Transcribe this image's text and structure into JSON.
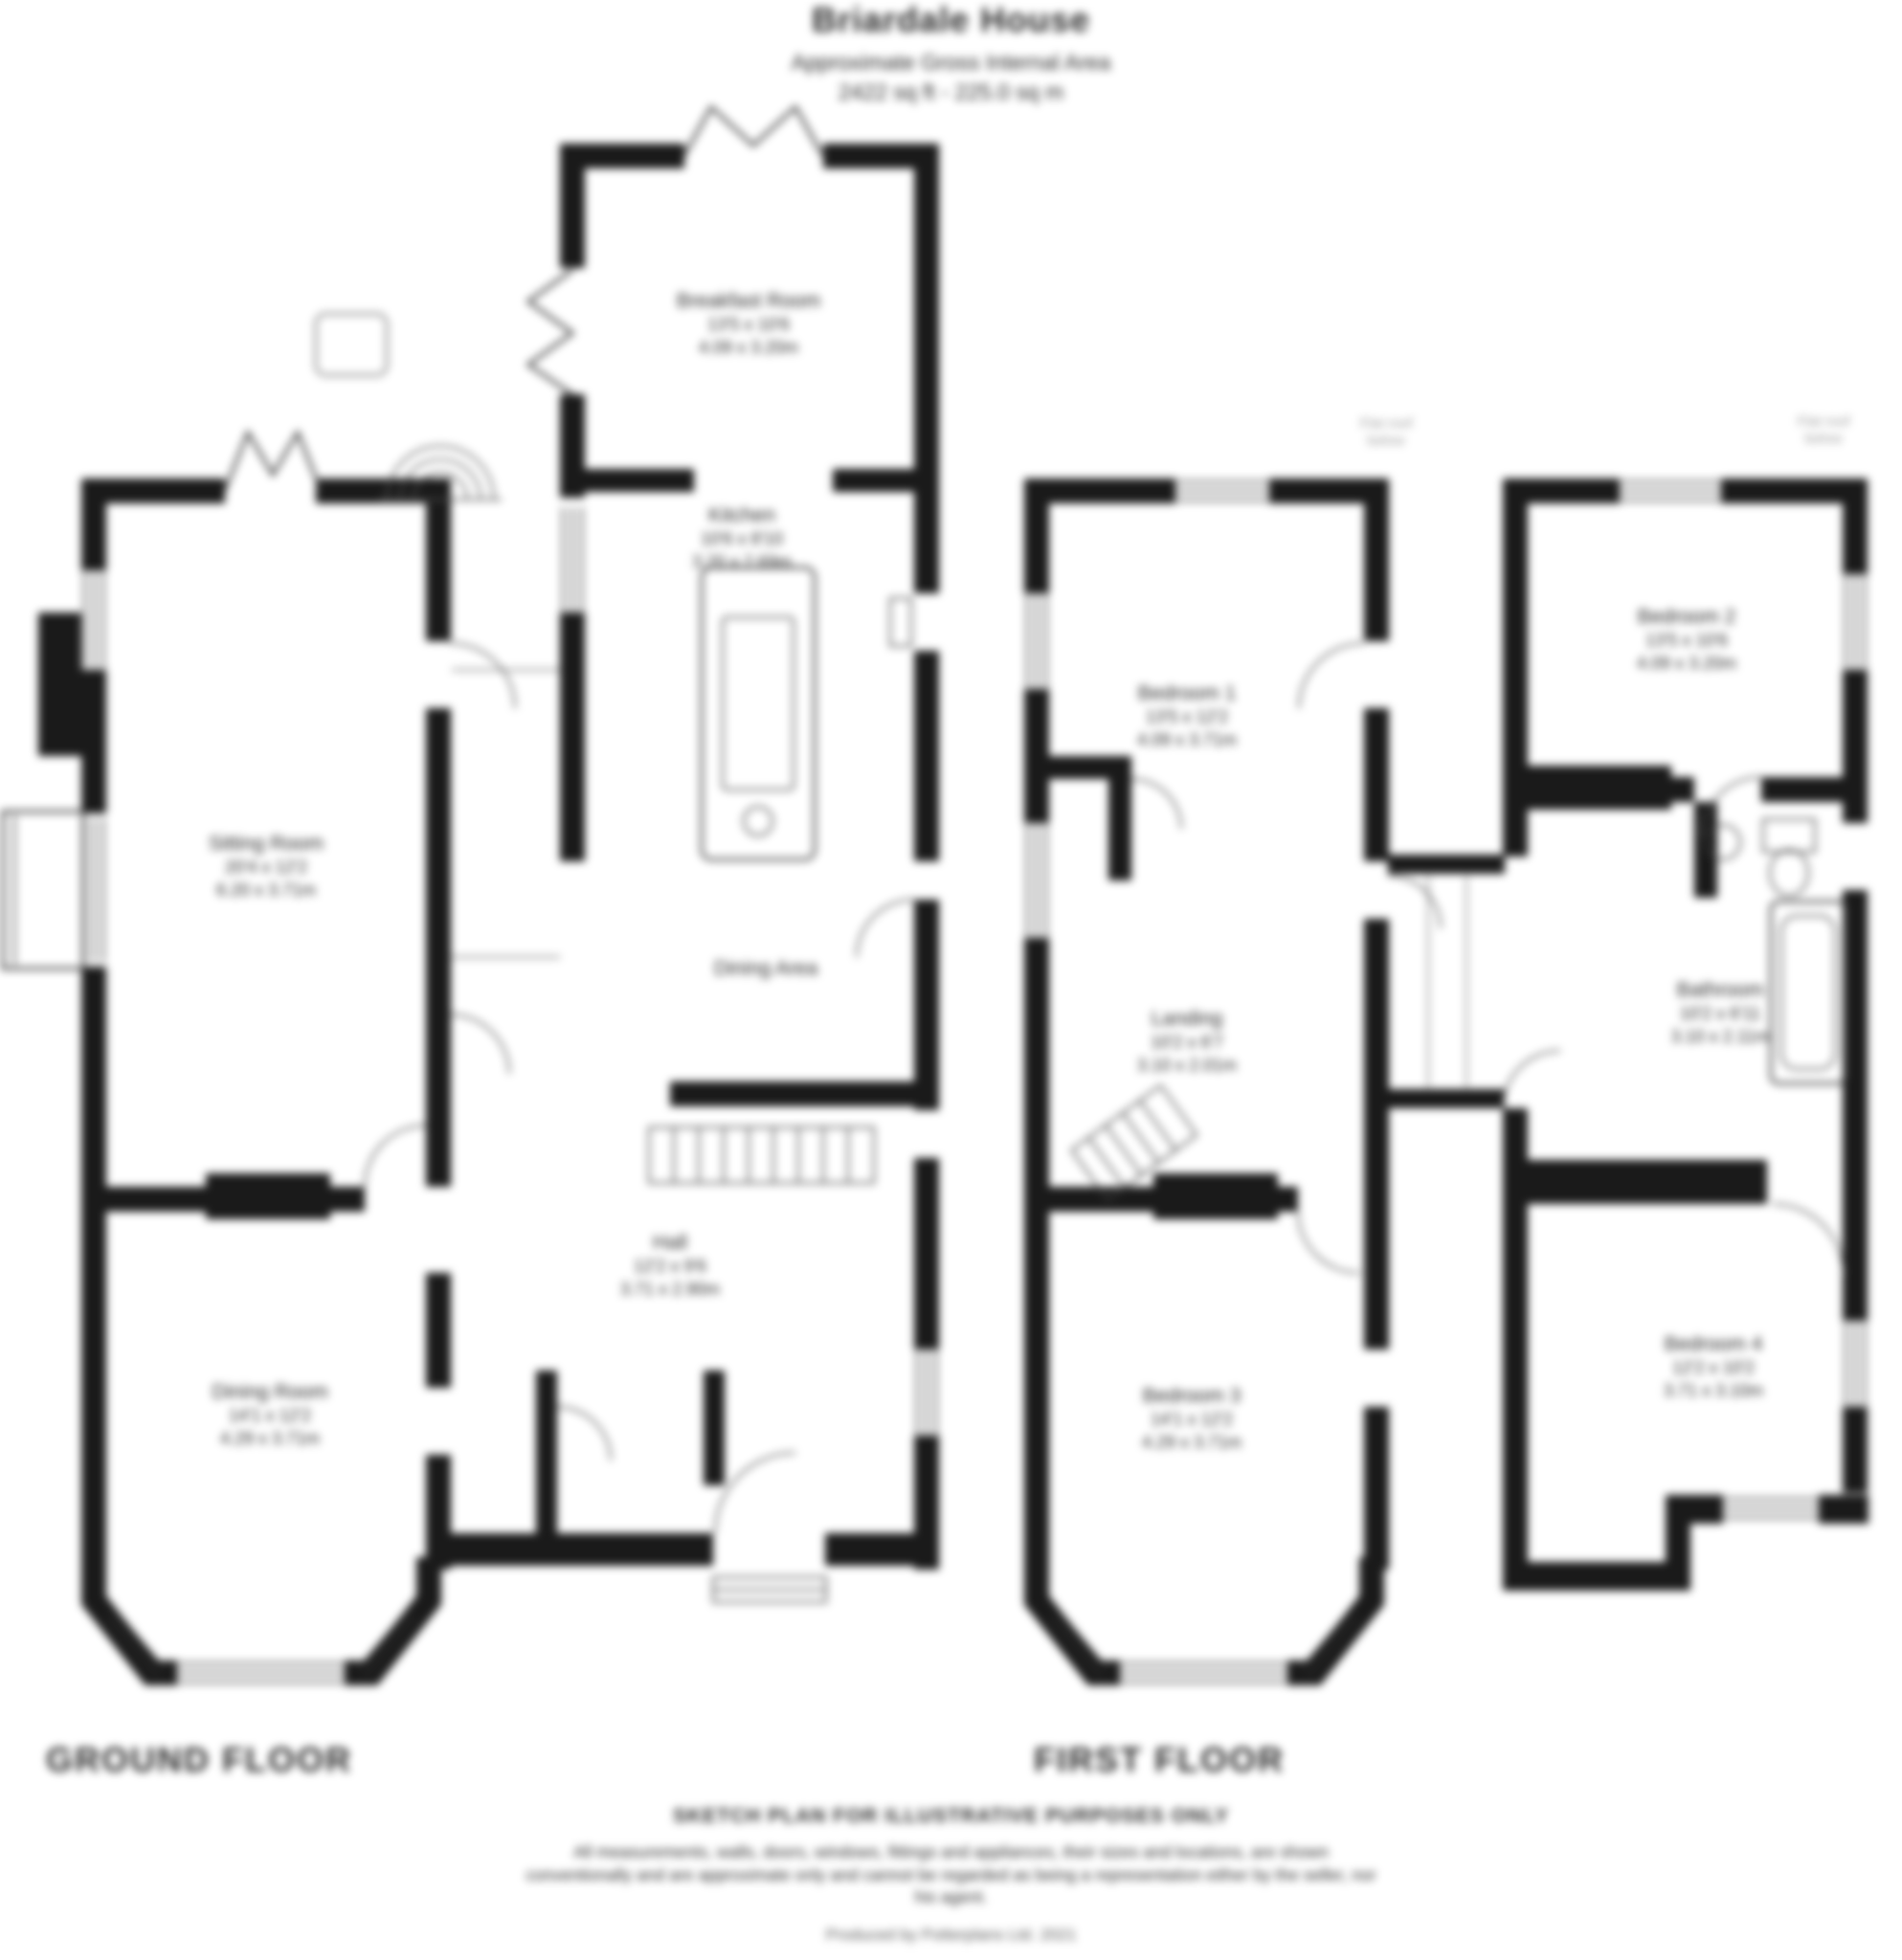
{
  "header": {
    "title": "Briardale House",
    "subtitle": "Approximate Gross Internal Area",
    "area": "2422 sq ft - 225.0 sq m"
  },
  "floors": {
    "ground": {
      "label": "GROUND FLOOR"
    },
    "first": {
      "label": "FIRST FLOOR"
    }
  },
  "rooms": {
    "sitting_room": {
      "name": "Sitting Room",
      "dims_ft": "20'4 x 12'2",
      "dims_m": "6.20 x 3.71m"
    },
    "breakfast_room": {
      "name": "Breakfast Room",
      "dims_ft": "13'5 x 10'6",
      "dims_m": "4.09 x 3.20m"
    },
    "kitchen": {
      "name": "Kitchen",
      "dims_ft": "10'6 x 8'10",
      "dims_m": "3.20 x 2.69m"
    },
    "dining_area": {
      "name": "Dining Area"
    },
    "hall": {
      "name": "Hall",
      "dims_ft": "12'2 x 9'6",
      "dims_m": "3.71 x 2.90m"
    },
    "dining_room": {
      "name": "Dining Room",
      "dims_ft": "14'1 x 12'2",
      "dims_m": "4.29 x 3.71m"
    },
    "bedroom1": {
      "name": "Bedroom 1",
      "dims_ft": "13'5 x 12'2",
      "dims_m": "4.09 x 3.71m"
    },
    "bedroom2": {
      "name": "Bedroom 2",
      "dims_ft": "13'5 x 10'6",
      "dims_m": "4.09 x 3.20m"
    },
    "landing": {
      "name": "Landing",
      "dims_ft": "10'2 x 6'7",
      "dims_m": "3.10 x 2.01m"
    },
    "bathroom": {
      "name": "Bathroom",
      "dims_ft": "10'2 x 6'11",
      "dims_m": "3.10 x 2.11m"
    },
    "bedroom3": {
      "name": "Bedroom 3",
      "dims_ft": "14'1 x 12'2",
      "dims_m": "4.29 x 3.71m"
    },
    "bedroom4": {
      "name": "Bedroom 4",
      "dims_ft": "12'2 x 10'2",
      "dims_m": "3.71 x 3.10m"
    }
  },
  "annotations": {
    "flat_roof_left": {
      "line1": "Flat roof",
      "line2": "below"
    },
    "flat_roof_right": {
      "line1": "Flat roof",
      "line2": "below"
    }
  },
  "footer": {
    "disclaimer_title": "SKETCH PLAN FOR ILLUSTRATIVE PURPOSES ONLY",
    "disclaimer_body": "All measurements, walls, doors, windows, fittings and appliances, their sizes and locations, are shown conventionally and are approximate only and cannot be regarded as being a representation either by the seller, nor his agent.",
    "produced_by": "Produced by Potterplans Ltd. 2021"
  },
  "colors": {
    "wall": "#1a1a1a",
    "line": "#444444",
    "text": "#2b2b2b",
    "faint": "#9a9a9a"
  }
}
